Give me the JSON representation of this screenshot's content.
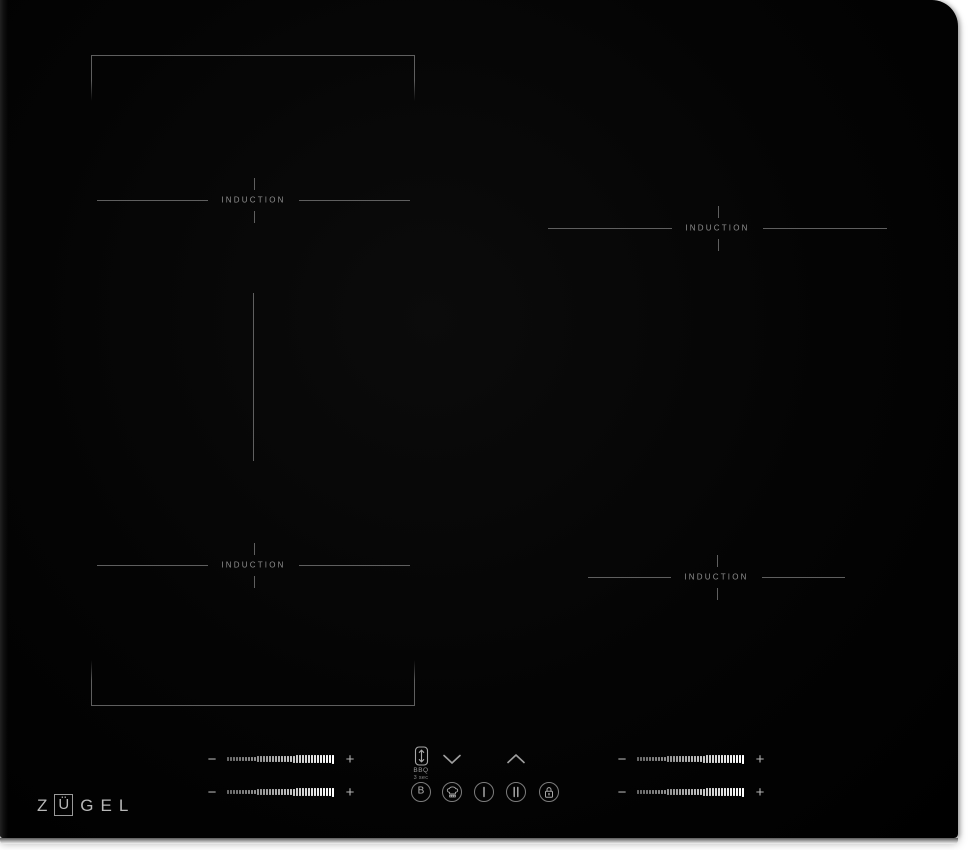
{
  "brand": {
    "name": "ZÜGEL",
    "letters": [
      "Z",
      "Ü",
      "G",
      "E",
      "L"
    ],
    "boxed_letter": "Ü"
  },
  "zones": [
    {
      "position": "left-top",
      "label": "INDUCTION"
    },
    {
      "position": "left-bottom",
      "label": "INDUCTION"
    },
    {
      "position": "right-top",
      "label": "INDUCTION"
    },
    {
      "position": "right-bottom",
      "label": "INDUCTION"
    }
  ],
  "flex_zone": {
    "type": "bridge",
    "divider": true
  },
  "controls": {
    "sliders": {
      "minus_label": "−",
      "plus_label": "+",
      "tick_count": 36,
      "instances": [
        {
          "zone": "left-top"
        },
        {
          "zone": "left-bottom"
        },
        {
          "zone": "right-top"
        },
        {
          "zone": "right-bottom"
        }
      ]
    },
    "flex_button": {
      "label": "BBQ",
      "sublabel": "3 sec",
      "icon": "flex-bridge-arrows-icon"
    },
    "level_down": {
      "icon": "chevron-down-icon"
    },
    "level_up": {
      "icon": "chevron-up-icon"
    },
    "buttons": [
      {
        "id": "booster",
        "label": "B",
        "icon": "circled-b-icon"
      },
      {
        "id": "keep-warm",
        "icon": "chef-hat-icon"
      },
      {
        "id": "power",
        "icon": "single-bar-icon"
      },
      {
        "id": "pause",
        "icon": "double-bar-icon"
      },
      {
        "id": "child-lock",
        "icon": "padlock-icon"
      }
    ]
  },
  "colors": {
    "background": "#ffffff",
    "surface": "#060606",
    "zone_line": "#5f5f5f",
    "zone_text": "#8f8f8f",
    "control_text": "#b5b5b5",
    "logo": "#b8b8b8"
  }
}
